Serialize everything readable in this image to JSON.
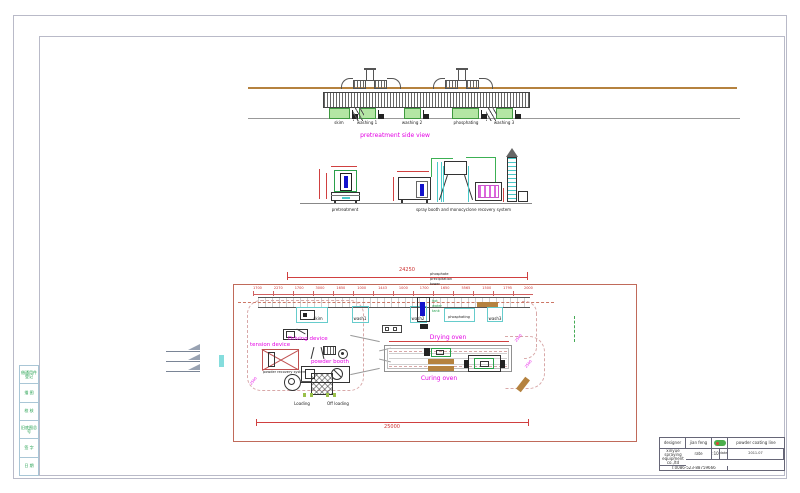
{
  "colors": {
    "dimension_red": "#cc3030",
    "label_magenta": "#e400e4",
    "machine_green": "#2aa04a",
    "tank_green": "#b4e6a4",
    "cyan": "#66cccc",
    "beam_tan": "#b5823f",
    "border_gray": "#b9bac8",
    "cartridge_magenta": "#dd66dd",
    "blue": "#1212cc"
  },
  "side_view": {
    "caption": "pretreatment side view",
    "tank_labels": [
      "skim",
      "washing 1",
      "washing 2",
      "phosphating",
      "washing 3"
    ]
  },
  "detail_views": {
    "left_caption": "pretreatment",
    "right_caption": "spray booth and monocyclone recovery system"
  },
  "plan_view": {
    "overall_top_dim": "24250",
    "overall_bottom_dim": "25000",
    "tower_note_lines": [
      "phosphate",
      "precipitation",
      "tower"
    ],
    "hot_water_note_lines": [
      "hot",
      "water",
      "tank"
    ],
    "segment_dims": [
      "1700",
      "2270",
      "1700",
      "3000",
      "1650",
      "1000",
      "1443",
      "1000",
      "1700",
      "1650",
      "5565",
      "1500",
      "1795",
      "2000"
    ],
    "station_labels": [
      "skim",
      "wash1",
      "wash2",
      "phosphating",
      "wash3"
    ],
    "loading_label": "Loading",
    "offloading_label": "Off loading",
    "driving_device_label": "Driving device",
    "tension_device_label": "tension device",
    "powder_booth_label": "powder booth",
    "powder_recovery_label": "powder recovery system",
    "drying_oven_label": "Drying oven",
    "curing_oven_label": "Curing oven",
    "radius_dims": [
      "2500",
      "2500",
      "2500"
    ]
  },
  "title_block": {
    "designer_label": "designer",
    "designer_value": "jian feng",
    "scale_label": "rate",
    "scale_value": "1:100",
    "date_label": "date",
    "date_value": "2011.07",
    "phone": "T:0086-523-88759666",
    "project": "powder coating line",
    "company_lines": [
      "xinyue spraying",
      "equipment co.,ltd"
    ]
  },
  "revision_strip": [
    "借通用件登记",
    "描 图",
    "校 核",
    "旧底图总号",
    "签 字",
    "日 期"
  ]
}
